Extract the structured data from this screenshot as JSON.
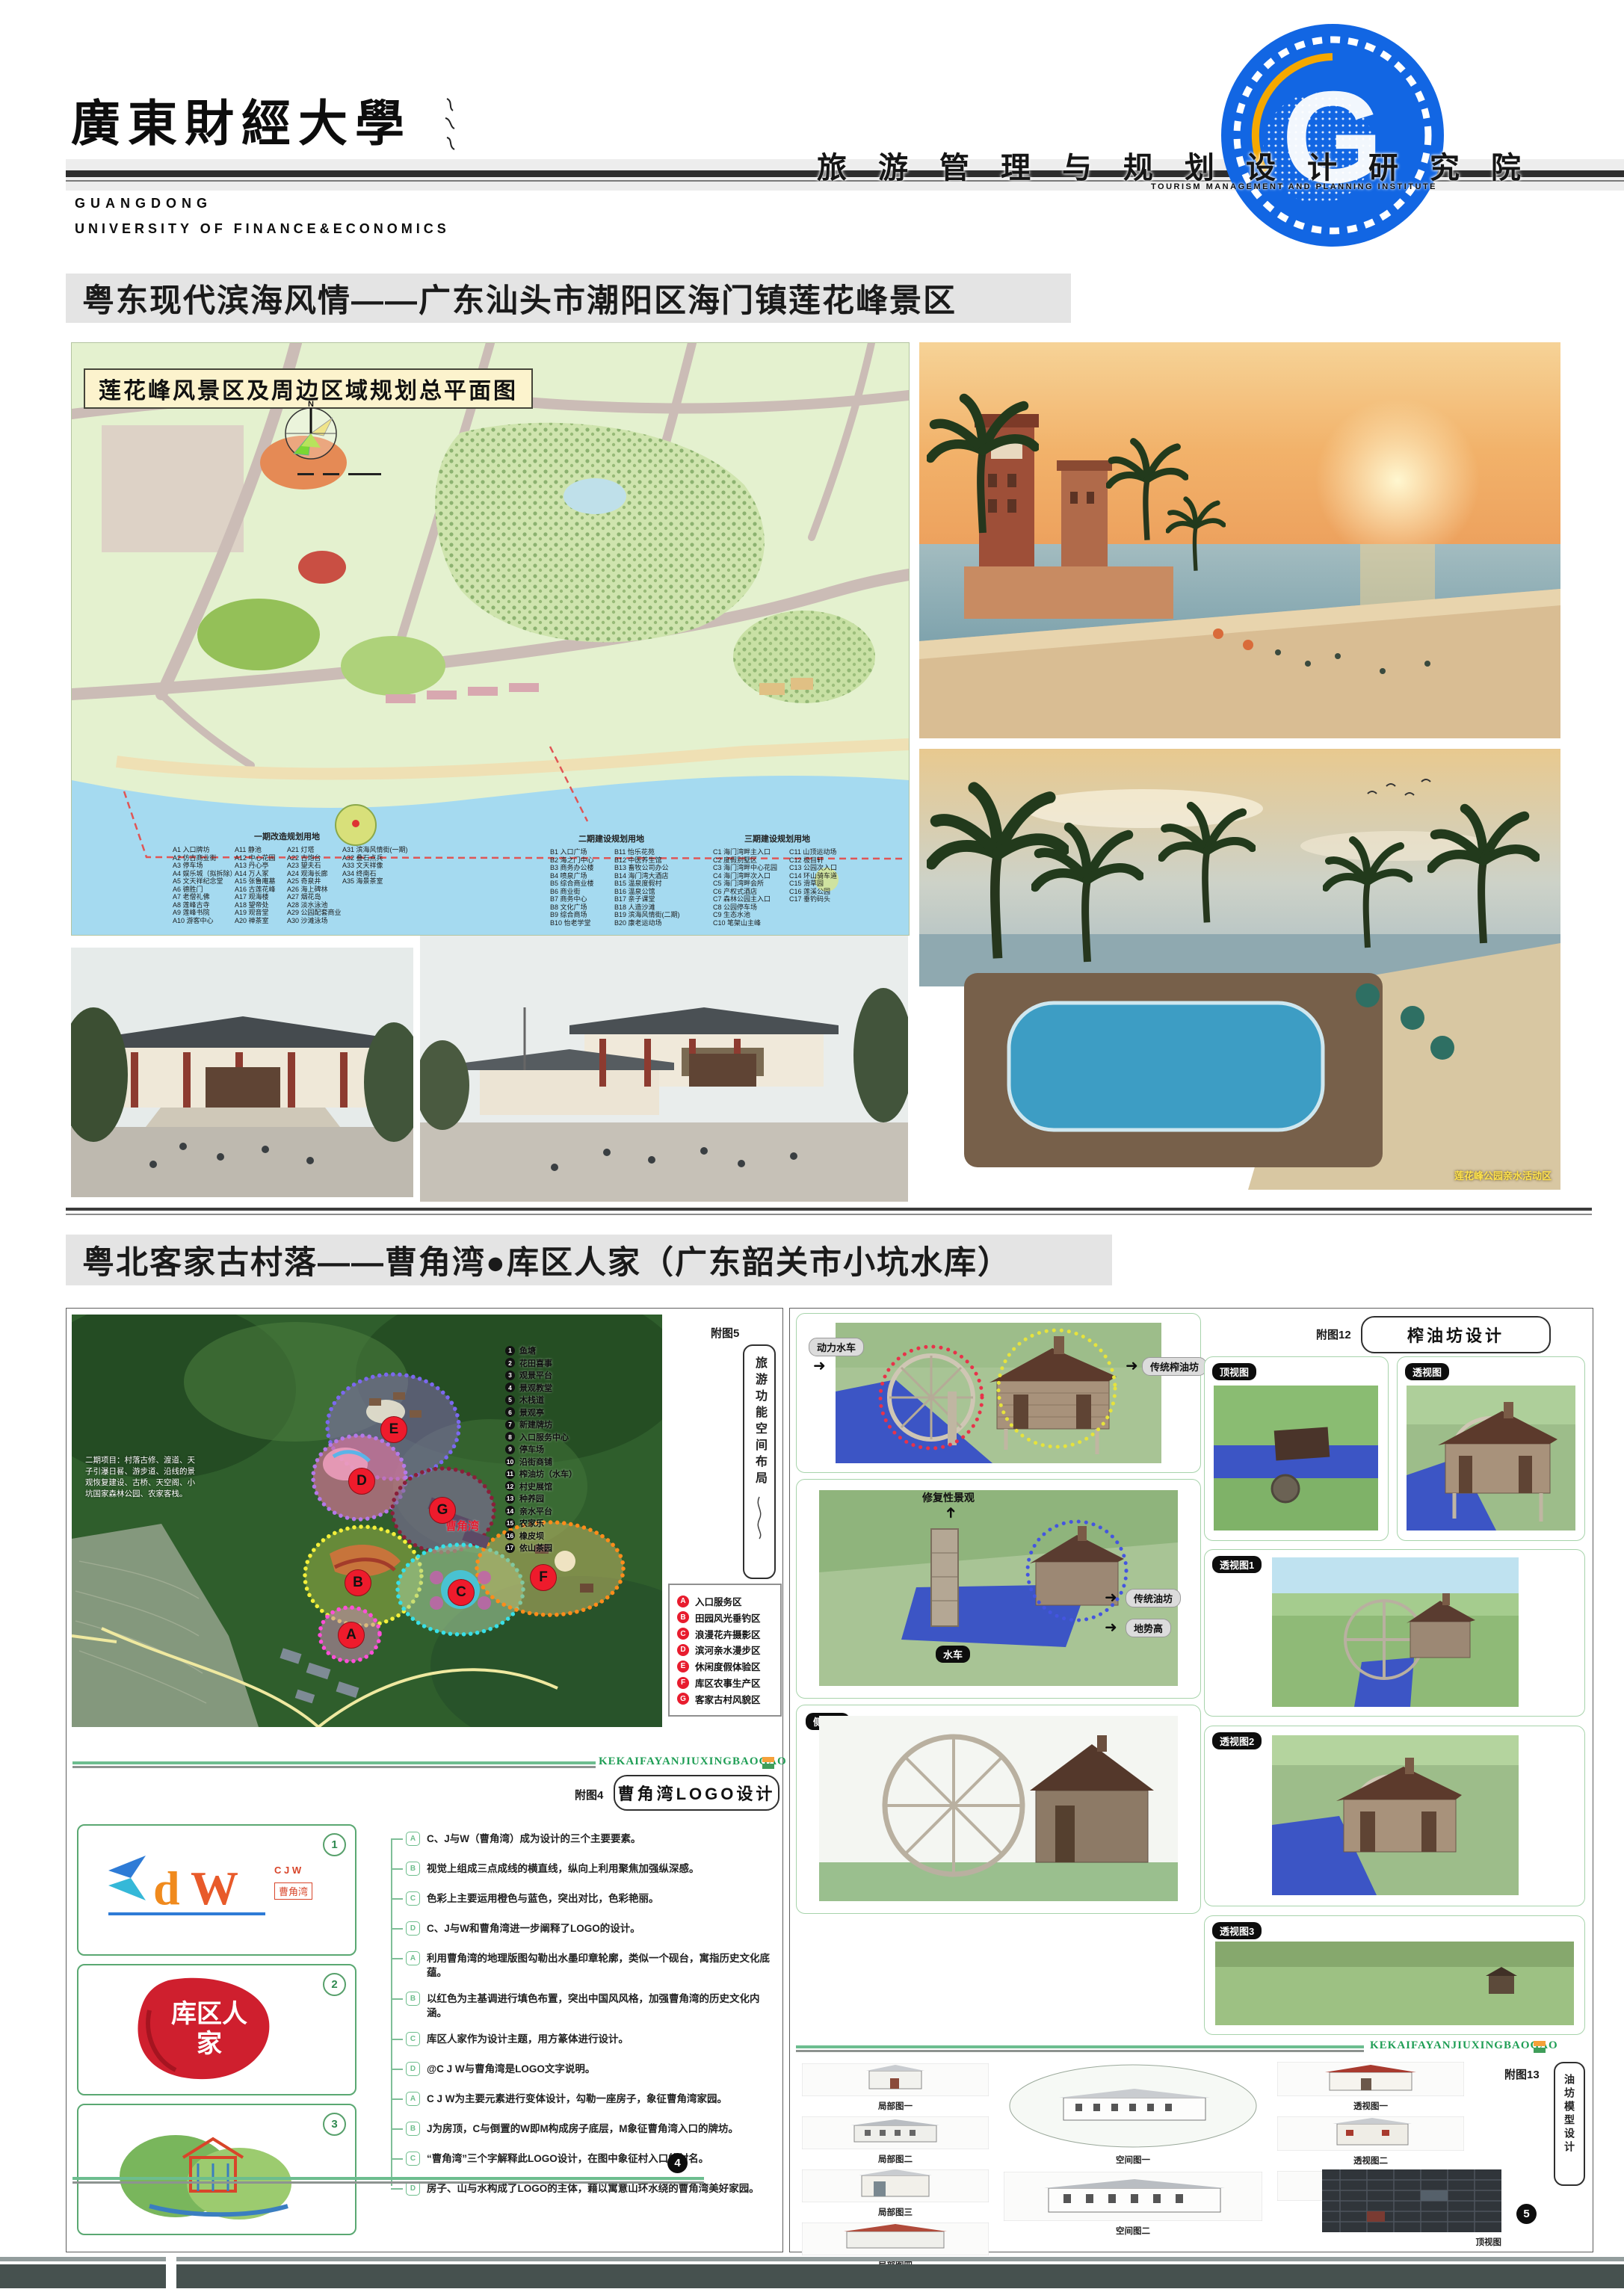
{
  "header": {
    "university_cn": "廣東財經大學",
    "university_en1": "GUANGDONG",
    "university_en2": "UNIVERSITY OF FINANCE&ECONOMICS",
    "institute_cn": "旅游管理与规划设计研究院",
    "institute_en": "TOURISM MANAGEMENT AND PLANNING INSTITUTE",
    "logo_letter": "G"
  },
  "section1": {
    "title": "粤东现代滨海风情——广东汕头市潮阳区海门镇莲花峰景区",
    "map": {
      "label": "莲花峰风景区及周边区域规划总平面图",
      "north": "N",
      "legend": {
        "g1": {
          "title": "一期改造规划用地",
          "c1": [
            "A1 入口牌坊",
            "A2 仿古商业街",
            "A3 停车场",
            "A4 娱乐城（拟拆除）",
            "A5 文天祥纪念堂",
            "A6 德胜门",
            "A7 老僧礼佛",
            "A8 莲峰古寺",
            "A9 莲峰书院",
            "A10 游客中心"
          ],
          "c2": [
            "A11 静池",
            "A12 中心花园",
            "A13 丹心亭",
            "A14 万人冢",
            "A15 张鲁庵墓",
            "A16 古莲花峰",
            "A17 观海楼",
            "A18 望帝处",
            "A19 观音堂",
            "A20 禅茶室"
          ],
          "c3": [
            "A21 灯塔",
            "A22 古炮台",
            "A23 望夫石",
            "A24 观海长廊",
            "A25 奇泉井",
            "A26 海上碑林",
            "A27 烟花岛",
            "A28 淡水泳池",
            "A29 公园配套商业",
            "A30 沙滩泳场"
          ],
          "c4": [
            "A31 滨海风情街(一期)",
            "A32 叠石点兵",
            "A33 文天祥像",
            "A34 终南石",
            "A35 海景茶室"
          ]
        },
        "g2": {
          "title": "二期建设规划用地",
          "c1": [
            "B1 入口广场",
            "B2 海之门中心",
            "B3 商务办公楼",
            "B4 喷泉广场",
            "B5 综合商业楼",
            "B6 商业街",
            "B7 商务中心",
            "B8 文化广场",
            "B9 综合商场",
            "B10 怡老学堂"
          ],
          "c2": [
            "B11 怡乐花苑",
            "B12 中医养生馆",
            "B13 畜牧公司办公",
            "B14 海门湾大酒店",
            "B15 温泉度假村",
            "B16 温泉公馆",
            "B17 亲子课堂",
            "B18 人造沙滩",
            "B19 滨海风情街(二期)",
            "B20 康老运动场"
          ]
        },
        "g3": {
          "title": "三期建设规划用地",
          "c1": [
            "C1 海门湾畔主入口",
            "C2 度假别墅区",
            "C3 海门湾畔中心花园",
            "C4 海门湾畔次入口",
            "C5 海门湾畔会所",
            "C6 产权式酒店",
            "C7 森林公园主入口",
            "C8 公园停车场",
            "C9 生态水池",
            "C10 笔架山主峰"
          ],
          "c2": [
            "C11 山顶运动场",
            "C12 极目轩",
            "C13 公园次入口",
            "C14 环山骑车道",
            "C15 滑草园",
            "C16 莲溪公园",
            "C17 垂钓码头"
          ]
        }
      }
    },
    "pool_caption": "莲花峰公园亲水活动区"
  },
  "section2": {
    "title": "粤北客家古村落——曹角湾●库区人家（广东韶关市小坑水库）",
    "spatial": {
      "fig_no": "附图5",
      "fig_label": "旅游功能空间布局",
      "village": "曹角湾",
      "phase2_note": "二期项目：村落古修、渡道、天子引瀑日晷、游步道、沿线的景观恢复建设、古桥、天空阁、小坑国家森林公园、农家客栈。",
      "points": [
        "1|鱼塘",
        "2|花田喜事",
        "3|观景平台",
        "4|景观教堂",
        "5|木栈道",
        "6|景观亭",
        "7|新建牌坊",
        "8|入口服务中心",
        "9|停车场",
        "10|沿街商铺",
        "11|榨油坊（水车）",
        "12|村史展馆",
        "13|种养园",
        "14|亲水平台",
        "15|农家乐",
        "16|橡皮坝",
        "17|依山茶园"
      ],
      "zones": [
        "A|入口服务区",
        "B|田园风光垂钓区",
        "C|浪漫花卉摄影区",
        "D|滨河亲水漫步区",
        "E|休闲度假体验区",
        "F|库区农事生产区",
        "G|客家古村风貌区"
      ]
    },
    "logo": {
      "fig_no": "附图4",
      "header": "曹角湾LOGO设计",
      "divider": "KEKAIFAYANJIUXINGBAOGAO",
      "badge1": "1",
      "badge2": "2",
      "badge3": "3",
      "box1_letters": "C J W",
      "box1_sub": "曹角湾",
      "box2_text": "库区人家",
      "items": [
        "A|C、J与W（曹角湾）成为设计的三个主要要素。",
        "B|视觉上组成三点成线的横直线，纵向上利用聚焦加强纵深感。",
        "C|色彩上主要运用橙色与蓝色，突出对比，色彩艳丽。",
        "D|C、J与W和曹角湾进一步阐释了LOGO的设计。",
        "A|利用曹角湾的地理版图勾勒出水墨印章轮廓，类似一个砚台，寓指历史文化底蕴。",
        "B|以红色为主基调进行填色布置，突出中国风风格，加强曹角湾的历史文化内涵。",
        "C|库区人家作为设计主题，用方篆体进行设计。",
        "D|@C J W与曹角湾是LOGO文字说明。",
        "A|C J W为主要元素进行变体设计，勾勒一座房子，象征曹角湾家园。",
        "B|J为房顶，C与倒置的W即M构成房子底层，M象征曹角湾入口的牌坊。",
        "C|“曹角湾”三个字解释此LOGO设计，在图中象征村入口的村名。",
        "D|房子、山与水构成了LOGO的主体，藉以寓意山环水绕的曹角湾美好家园。"
      ],
      "page_no": "4"
    },
    "oil": {
      "fig_no": "附图12",
      "header": "榨油坊设计",
      "wheel": "动力水车",
      "mill": "传统榨油坊",
      "restore": "修复性景观",
      "shuiche": "水车",
      "youfang": "传统油坊",
      "dishi": "地势高",
      "top_view": "顶视图",
      "persp_view": "透视图",
      "side_view": "侧视图",
      "p1": "透视图1",
      "p2": "透视图2",
      "p3": "透视图3"
    },
    "model": {
      "fig_no": "附图13",
      "side_label": "油坊模型设计",
      "divider": "KEKAIFAYANJIUXINGBAOGAO",
      "l1": "局部图一",
      "l2": "局部图二",
      "l3": "局部图三",
      "l4": "局部图四",
      "s1": "空间图一",
      "s2": "空间图二",
      "p1": "透视图一",
      "p2": "透视图二",
      "p3": "透视图三",
      "top_view": "顶视图",
      "page_no": "5"
    }
  }
}
